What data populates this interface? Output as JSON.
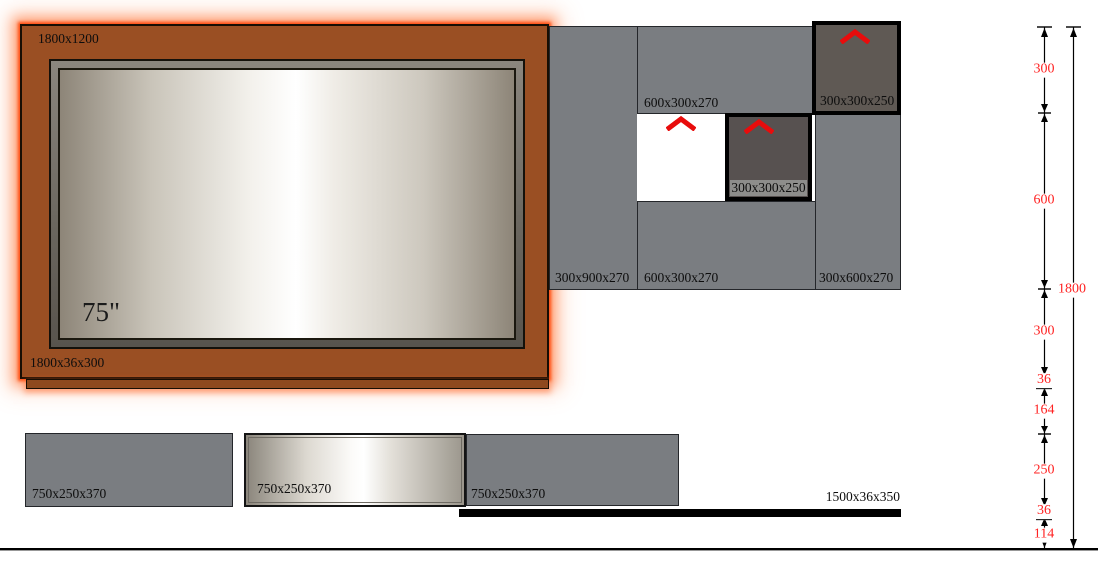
{
  "drawing": {
    "type": "media-wall elevation drawing",
    "colors": {
      "panel_brown": "#9a4f23",
      "glow_orange": "#ff5a1a",
      "panel_gray": "#7a7d81",
      "dark_box": "#575150",
      "dimension_red": "#ff2222",
      "chevron_red": "#e80c0c"
    }
  },
  "tv_unit": {
    "size_label": "1800x1200",
    "shelf_label": "1800x36x300",
    "tv_label": "75\""
  },
  "upper_cabinets": {
    "left_panel": "300x900x270",
    "top_panel": "600x300x270",
    "bottom_panel": "600x300x270",
    "right_panel": "300x600x270",
    "dark_box_mid": "300x300x250",
    "dark_box_top": "300x300x250"
  },
  "lower_cabinets": {
    "left": "750x250x370",
    "middle": "750x250x370",
    "right": "750x250x370",
    "shelf": "1500x36x350"
  },
  "dimensions": {
    "total": "1800",
    "segments": [
      "300",
      "600",
      "300",
      "36",
      "164",
      "250",
      "36",
      "114"
    ]
  },
  "icons": {
    "chevron_meaning": "flap-up-door-arrow"
  }
}
